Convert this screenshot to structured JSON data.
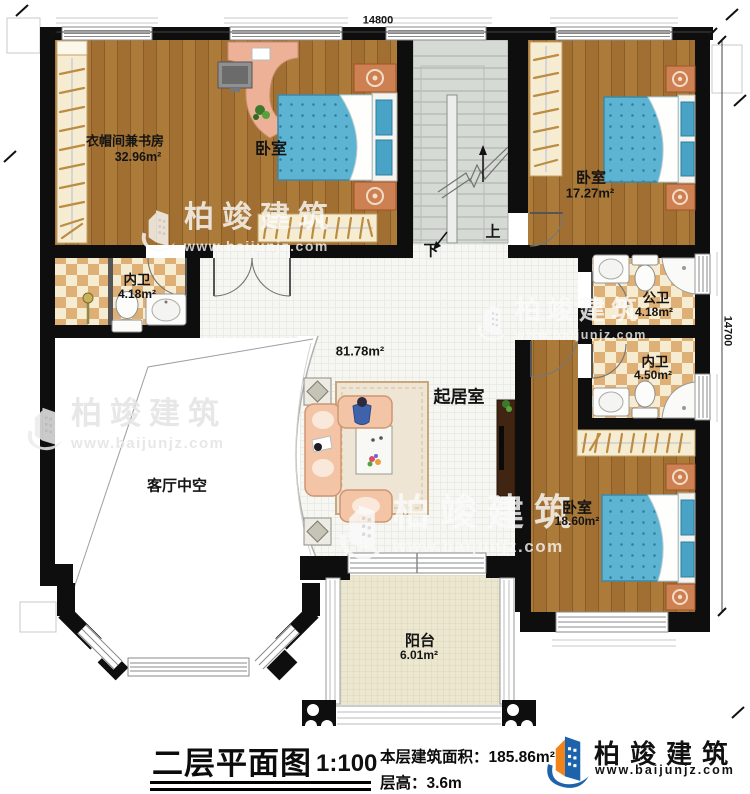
{
  "dimensions": {
    "top": "14800",
    "right": "14700"
  },
  "rooms": {
    "study": {
      "name": "衣帽间兼书房",
      "area": "32.96m²"
    },
    "bedroom_top": {
      "name": "卧室"
    },
    "bedroom_right": {
      "name": "卧室",
      "area": "17.27m²"
    },
    "bath_left": {
      "name": "内卫",
      "area": "4.18m²"
    },
    "bath_public": {
      "name": "公卫",
      "area": "4.18m²"
    },
    "bath_inner": {
      "name": "内卫",
      "area": "4.50m²"
    },
    "living": {
      "name": "起居室",
      "area": "81.78m²"
    },
    "void": {
      "name": "客厅中空"
    },
    "bedroom_bottom": {
      "name": "卧室",
      "area": "18.60m²"
    },
    "balcony": {
      "name": "阳台",
      "area": "6.01m²"
    }
  },
  "stairs": {
    "up": "上",
    "down": "下"
  },
  "titleblock": {
    "title": "二层平面图",
    "scale": "1:100",
    "area_line": "本层建筑面积：185.86m²",
    "height_line": "层高：3.6m"
  },
  "brand": {
    "name": "柏竣建筑",
    "url": "www.baijunjz.com",
    "logo_icon": "baijun-building-logo"
  },
  "watermark": {
    "name": "柏竣建筑",
    "url": "www.baijunjz.com"
  },
  "colors": {
    "wall": "#0e0e0e",
    "brand_blue": "#1d63ac",
    "brand_orange": "#f08419",
    "wood": "#ab7a38",
    "bed_blue": "#5db3d2",
    "checker_tan": "#dfb076"
  }
}
